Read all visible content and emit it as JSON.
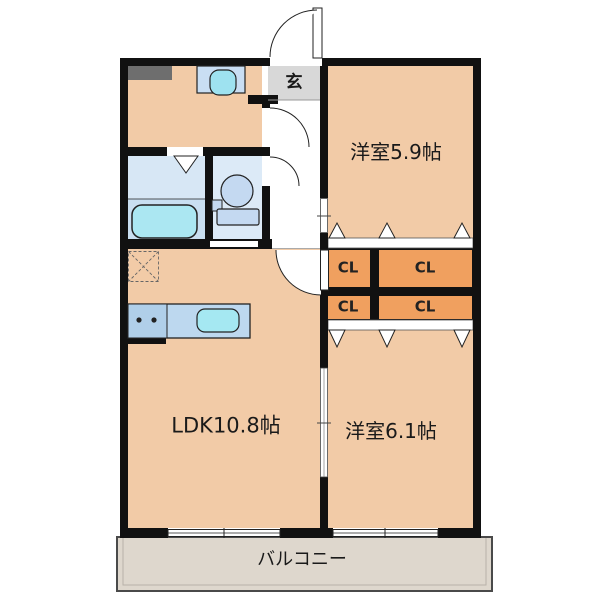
{
  "title": "2LDK apartment floor plan",
  "rooms": {
    "entrance": {
      "label": "玄"
    },
    "western_room_1": {
      "label": "洋室5.9帖"
    },
    "western_room_2": {
      "label": "洋室6.1帖"
    },
    "ldk": {
      "label": "LDK10.8帖"
    },
    "balcony": {
      "label": "バルコニー"
    },
    "closets": [
      {
        "label": "CL"
      },
      {
        "label": "CL"
      },
      {
        "label": "CL"
      },
      {
        "label": "CL"
      }
    ]
  },
  "colors": {
    "wall": "#111111",
    "room_floor": "#F2CBA7",
    "closet_fill": "#F0A05F",
    "wet_area_floor": "#D7E7F5",
    "bathtub": "#ABE7F2",
    "sink": "#A5E8F2",
    "counter": "#BDD8EF",
    "entrance_floor": "#D8D8D8",
    "balcony_floor": "#DED7CD",
    "appliance_gray": "#6E6E6E"
  }
}
